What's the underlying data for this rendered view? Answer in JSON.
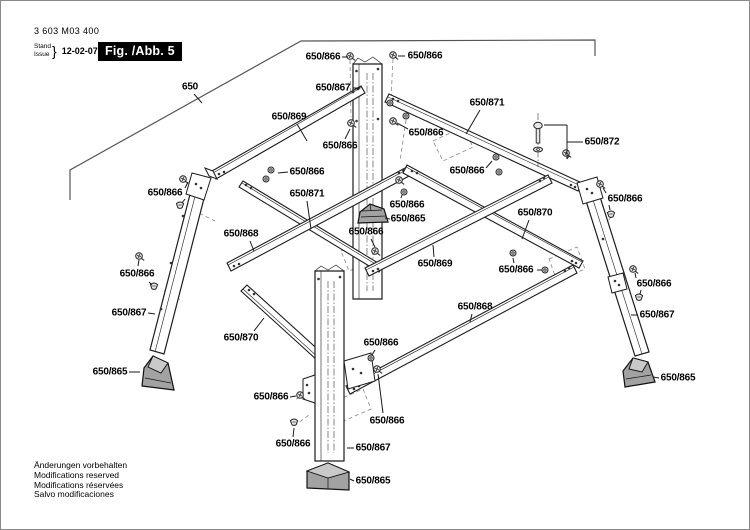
{
  "header": {
    "part_number": "3 603 M03 400",
    "stand_label": "Stand",
    "issue_label": "Issue",
    "brace": "}",
    "date": "12-02-07",
    "figure_label": "Fig. /Abb. 5"
  },
  "footer": {
    "lines": [
      "Änderungen vorbehalten",
      "Modifications reserved",
      "Modifications réservées",
      "Salvo modificaciones"
    ]
  },
  "diagram": {
    "colors": {
      "line": "#1c1c1c",
      "light_line": "#888888",
      "foot_fill": "#a2a2a2",
      "figure_box_bg": "#000000",
      "figure_box_text": "#ffffff"
    },
    "callouts": [
      {
        "label": "650",
        "x": 189,
        "y": 86,
        "leaders": [
          [
            [
              193,
              93
            ],
            [
              201,
              102
            ]
          ]
        ]
      },
      {
        "label": "650/866",
        "x": 322,
        "y": 56,
        "leaders": [
          [
            [
              341,
              56
            ],
            [
              347,
              56
            ]
          ]
        ]
      },
      {
        "label": "650/866",
        "x": 424,
        "y": 55,
        "leaders": [
          [
            [
              404,
              55
            ],
            [
              397,
              55
            ]
          ]
        ]
      },
      {
        "label": "650/867",
        "x": 332,
        "y": 87,
        "leaders": [
          [
            [
              352,
              87
            ],
            [
              359,
              87
            ]
          ]
        ]
      },
      {
        "label": "650/869",
        "x": 288,
        "y": 116,
        "leaders": [
          [
            [
              296,
              123
            ],
            [
              306,
              140
            ]
          ]
        ]
      },
      {
        "label": "650/871",
        "x": 486,
        "y": 102,
        "leaders": [
          [
            [
              479,
              109
            ],
            [
              465,
              133
            ]
          ]
        ]
      },
      {
        "label": "650/866",
        "x": 339,
        "y": 145,
        "leaders": [
          [
            [
              344,
              138
            ],
            [
              349,
              128
            ]
          ]
        ]
      },
      {
        "label": "650/866",
        "x": 425,
        "y": 132,
        "leaders": [
          [
            [
              407,
              128
            ],
            [
              396,
              122
            ]
          ]
        ]
      },
      {
        "label": "650/872",
        "x": 601,
        "y": 141,
        "leaders": [
          [
            [
              582,
              141
            ],
            [
              566,
              141
            ]
          ],
          [
            [
              566,
              124
            ],
            [
              566,
              158
            ]
          ],
          [
            [
              566,
              124
            ],
            [
              543,
              124
            ]
          ],
          [
            [
              566,
              158
            ],
            [
              568,
              155
            ]
          ]
        ]
      },
      {
        "label": "650/866",
        "x": 466,
        "y": 170,
        "leaders": [
          [
            [
              485,
              167
            ],
            [
              491,
              160
            ]
          ]
        ]
      },
      {
        "label": "650/866",
        "x": 306,
        "y": 171,
        "leaders": [
          [
            [
              287,
              171
            ],
            [
              277,
              172
            ]
          ]
        ]
      },
      {
        "label": "650/871",
        "x": 306,
        "y": 193,
        "leaders": [
          [
            [
              306,
              200
            ],
            [
              310,
              228
            ]
          ]
        ]
      },
      {
        "label": "650/868",
        "x": 240,
        "y": 233,
        "leaders": [
          [
            [
              249,
              240
            ],
            [
              253,
              250
            ]
          ]
        ]
      },
      {
        "label": "650/870",
        "x": 534,
        "y": 212,
        "leaders": [
          [
            [
              528,
              219
            ],
            [
              521,
              238
            ]
          ]
        ]
      },
      {
        "label": "650/869",
        "x": 434,
        "y": 263,
        "leaders": [
          [
            [
              433,
              256
            ],
            [
              432,
              244
            ]
          ]
        ]
      },
      {
        "label": "650/866",
        "x": 406,
        "y": 204,
        "leaders": [
          [
            [
              400,
              197
            ],
            [
              401,
              194
            ]
          ]
        ]
      },
      {
        "label": "650/865",
        "x": 407,
        "y": 218,
        "leaders": [
          [
            [
              389,
              218
            ],
            [
              384,
              217
            ]
          ]
        ]
      },
      {
        "label": "650/866",
        "x": 365,
        "y": 231,
        "leaders": [
          [
            [
              370,
              238
            ],
            [
              374,
              246
            ]
          ]
        ]
      },
      {
        "label": "650/866",
        "x": 515,
        "y": 269,
        "leaders": [
          [
            [
              536,
              269
            ],
            [
              541,
              269
            ]
          ],
          [
            [
              513,
              262
            ],
            [
              512,
              257
            ]
          ]
        ]
      },
      {
        "label": "650/866",
        "x": 164,
        "y": 192,
        "leaders": [
          [
            [
              184,
              187
            ],
            [
              187,
              181
            ]
          ],
          [
            [
              184,
              198
            ],
            [
              181,
              202
            ]
          ]
        ]
      },
      {
        "label": "650/866",
        "x": 136,
        "y": 273,
        "leaders": [
          [
            [
              137,
              265
            ],
            [
              138,
              259
            ]
          ],
          [
            [
              148,
              281
            ],
            [
              151,
              284
            ]
          ]
        ]
      },
      {
        "label": "650/867",
        "x": 128,
        "y": 312,
        "leaders": [
          [
            [
              147,
              312
            ],
            [
              154,
              313
            ]
          ]
        ]
      },
      {
        "label": "650/870",
        "x": 240,
        "y": 337,
        "leaders": [
          [
            [
              253,
              330
            ],
            [
              263,
              317
            ]
          ]
        ]
      },
      {
        "label": "650/865",
        "x": 109,
        "y": 371,
        "leaders": [
          [
            [
              128,
              371
            ],
            [
              139,
              371
            ]
          ]
        ]
      },
      {
        "label": "650/866",
        "x": 270,
        "y": 396,
        "leaders": [
          [
            [
              289,
              396
            ],
            [
              295,
              395
            ]
          ]
        ]
      },
      {
        "label": "650/866",
        "x": 292,
        "y": 443,
        "leaders": [
          [
            [
              292,
              436
            ],
            [
              293,
              427
            ]
          ]
        ]
      },
      {
        "label": "650/867",
        "x": 372,
        "y": 447,
        "leaders": [
          [
            [
              353,
              447
            ],
            [
              346,
              447
            ]
          ]
        ]
      },
      {
        "label": "650/865",
        "x": 372,
        "y": 480,
        "leaders": [
          [
            [
              353,
              480
            ],
            [
              349,
              478
            ]
          ]
        ]
      },
      {
        "label": "650/866",
        "x": 380,
        "y": 342,
        "leaders": [
          [
            [
              374,
              349
            ],
            [
              371,
              354
            ]
          ]
        ]
      },
      {
        "label": "650/866",
        "x": 386,
        "y": 420,
        "leaders": [
          [
            [
              382,
              412
            ],
            [
              377,
              373
            ]
          ]
        ]
      },
      {
        "label": "650/868",
        "x": 474,
        "y": 306,
        "leaders": [
          [
            [
              471,
              313
            ],
            [
              469,
              321
            ]
          ]
        ]
      },
      {
        "label": "650/866",
        "x": 624,
        "y": 198,
        "leaders": [
          [
            [
              605,
              192
            ],
            [
              602,
              187
            ]
          ],
          [
            [
              608,
              204
            ],
            [
              609,
              209
            ]
          ]
        ]
      },
      {
        "label": "650/866",
        "x": 653,
        "y": 283,
        "leaders": [
          [
            [
              635,
              277
            ],
            [
              634,
              272
            ]
          ],
          [
            [
              640,
              289
            ],
            [
              639,
              293
            ]
          ]
        ]
      },
      {
        "label": "650/867",
        "x": 656,
        "y": 314,
        "leaders": [
          [
            [
              637,
              314
            ],
            [
              630,
              314
            ]
          ]
        ]
      },
      {
        "label": "650/865",
        "x": 677,
        "y": 377,
        "leaders": [
          [
            [
              658,
              377
            ],
            [
              652,
              376
            ]
          ]
        ]
      }
    ]
  }
}
